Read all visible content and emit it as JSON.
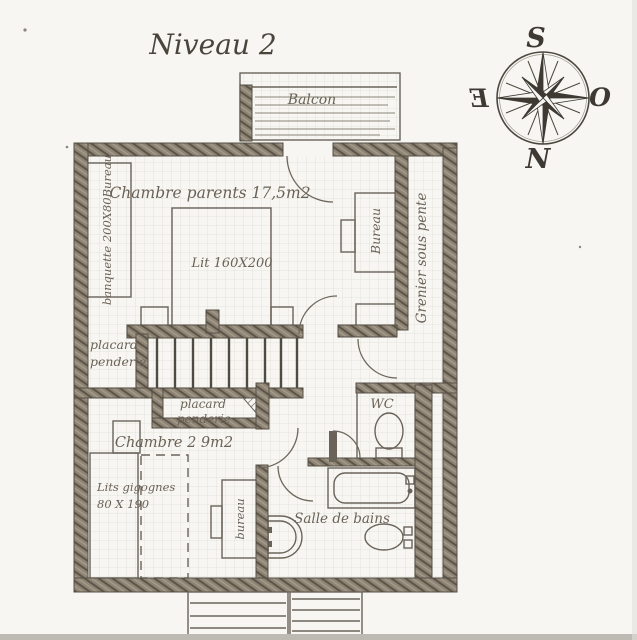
{
  "title": "Niveau 2",
  "compass": {
    "top": "S",
    "right": "O",
    "bottom": "N",
    "left": "E"
  },
  "labels": {
    "balcony": "Balcon",
    "master_bedroom": "Chambre parents 17,5m2",
    "bed": "Lit 160X200",
    "bench": "banquette 200X80Bureau",
    "desk_master": "Bureau",
    "attic": "Grenier sous pente",
    "closet_left": [
      "placard",
      "penderie"
    ],
    "closet_stairs": [
      "placard",
      "penderie"
    ],
    "wc": "WC",
    "bedroom2": "Chambre 2 9m2",
    "nesting_beds": [
      "Lits gigognes",
      "80 X 190"
    ],
    "desk_bedroom2": "bureau",
    "bathroom": "Salle de bains"
  },
  "colors": {
    "paper": "#f7f6f2",
    "ink": "#6a635a",
    "wall_fill": "#8e8576",
    "text": "#6b6257"
  }
}
